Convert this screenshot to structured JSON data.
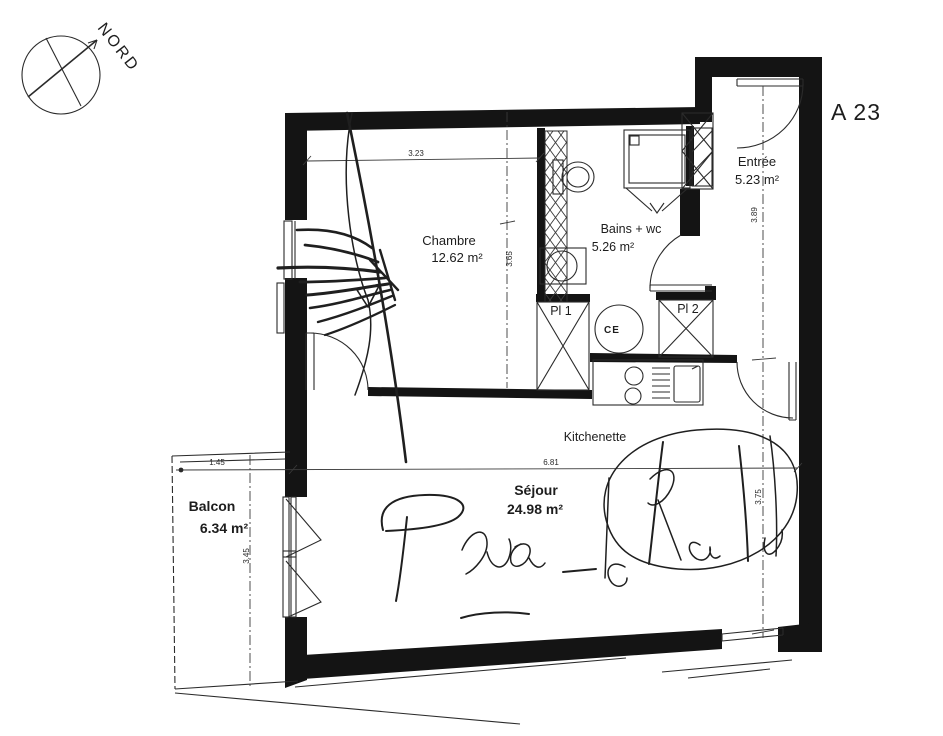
{
  "unit": {
    "label": "A 23"
  },
  "compass": {
    "label": "NORD"
  },
  "rooms": {
    "entree": {
      "name": "Entrée",
      "area": "5.23 m²"
    },
    "chambre": {
      "name": "Chambre",
      "area": "12.62 m²"
    },
    "bains": {
      "name": "Bains + wc",
      "area": "5.26 m²"
    },
    "sejour": {
      "name": "Séjour",
      "area": "24.98 m²"
    },
    "balcon": {
      "name": "Balcon",
      "area": "6.34 m²"
    },
    "kitchenette": {
      "name": "Kitchenette"
    }
  },
  "storage": {
    "pl1": "Pl 1",
    "pl2": "Pl 2",
    "water_heater": "CE"
  },
  "dimensions": {
    "chambre_width": "3.23",
    "chambre_depth": "3.65",
    "entree_depth": "3.89",
    "sejour_width": "6.81",
    "sejour_depth": "3.75",
    "balcon_width": "1.45",
    "balcon_depth": "3.45"
  },
  "colors": {
    "ink": "#1d1d1d",
    "wall": "#141414"
  }
}
